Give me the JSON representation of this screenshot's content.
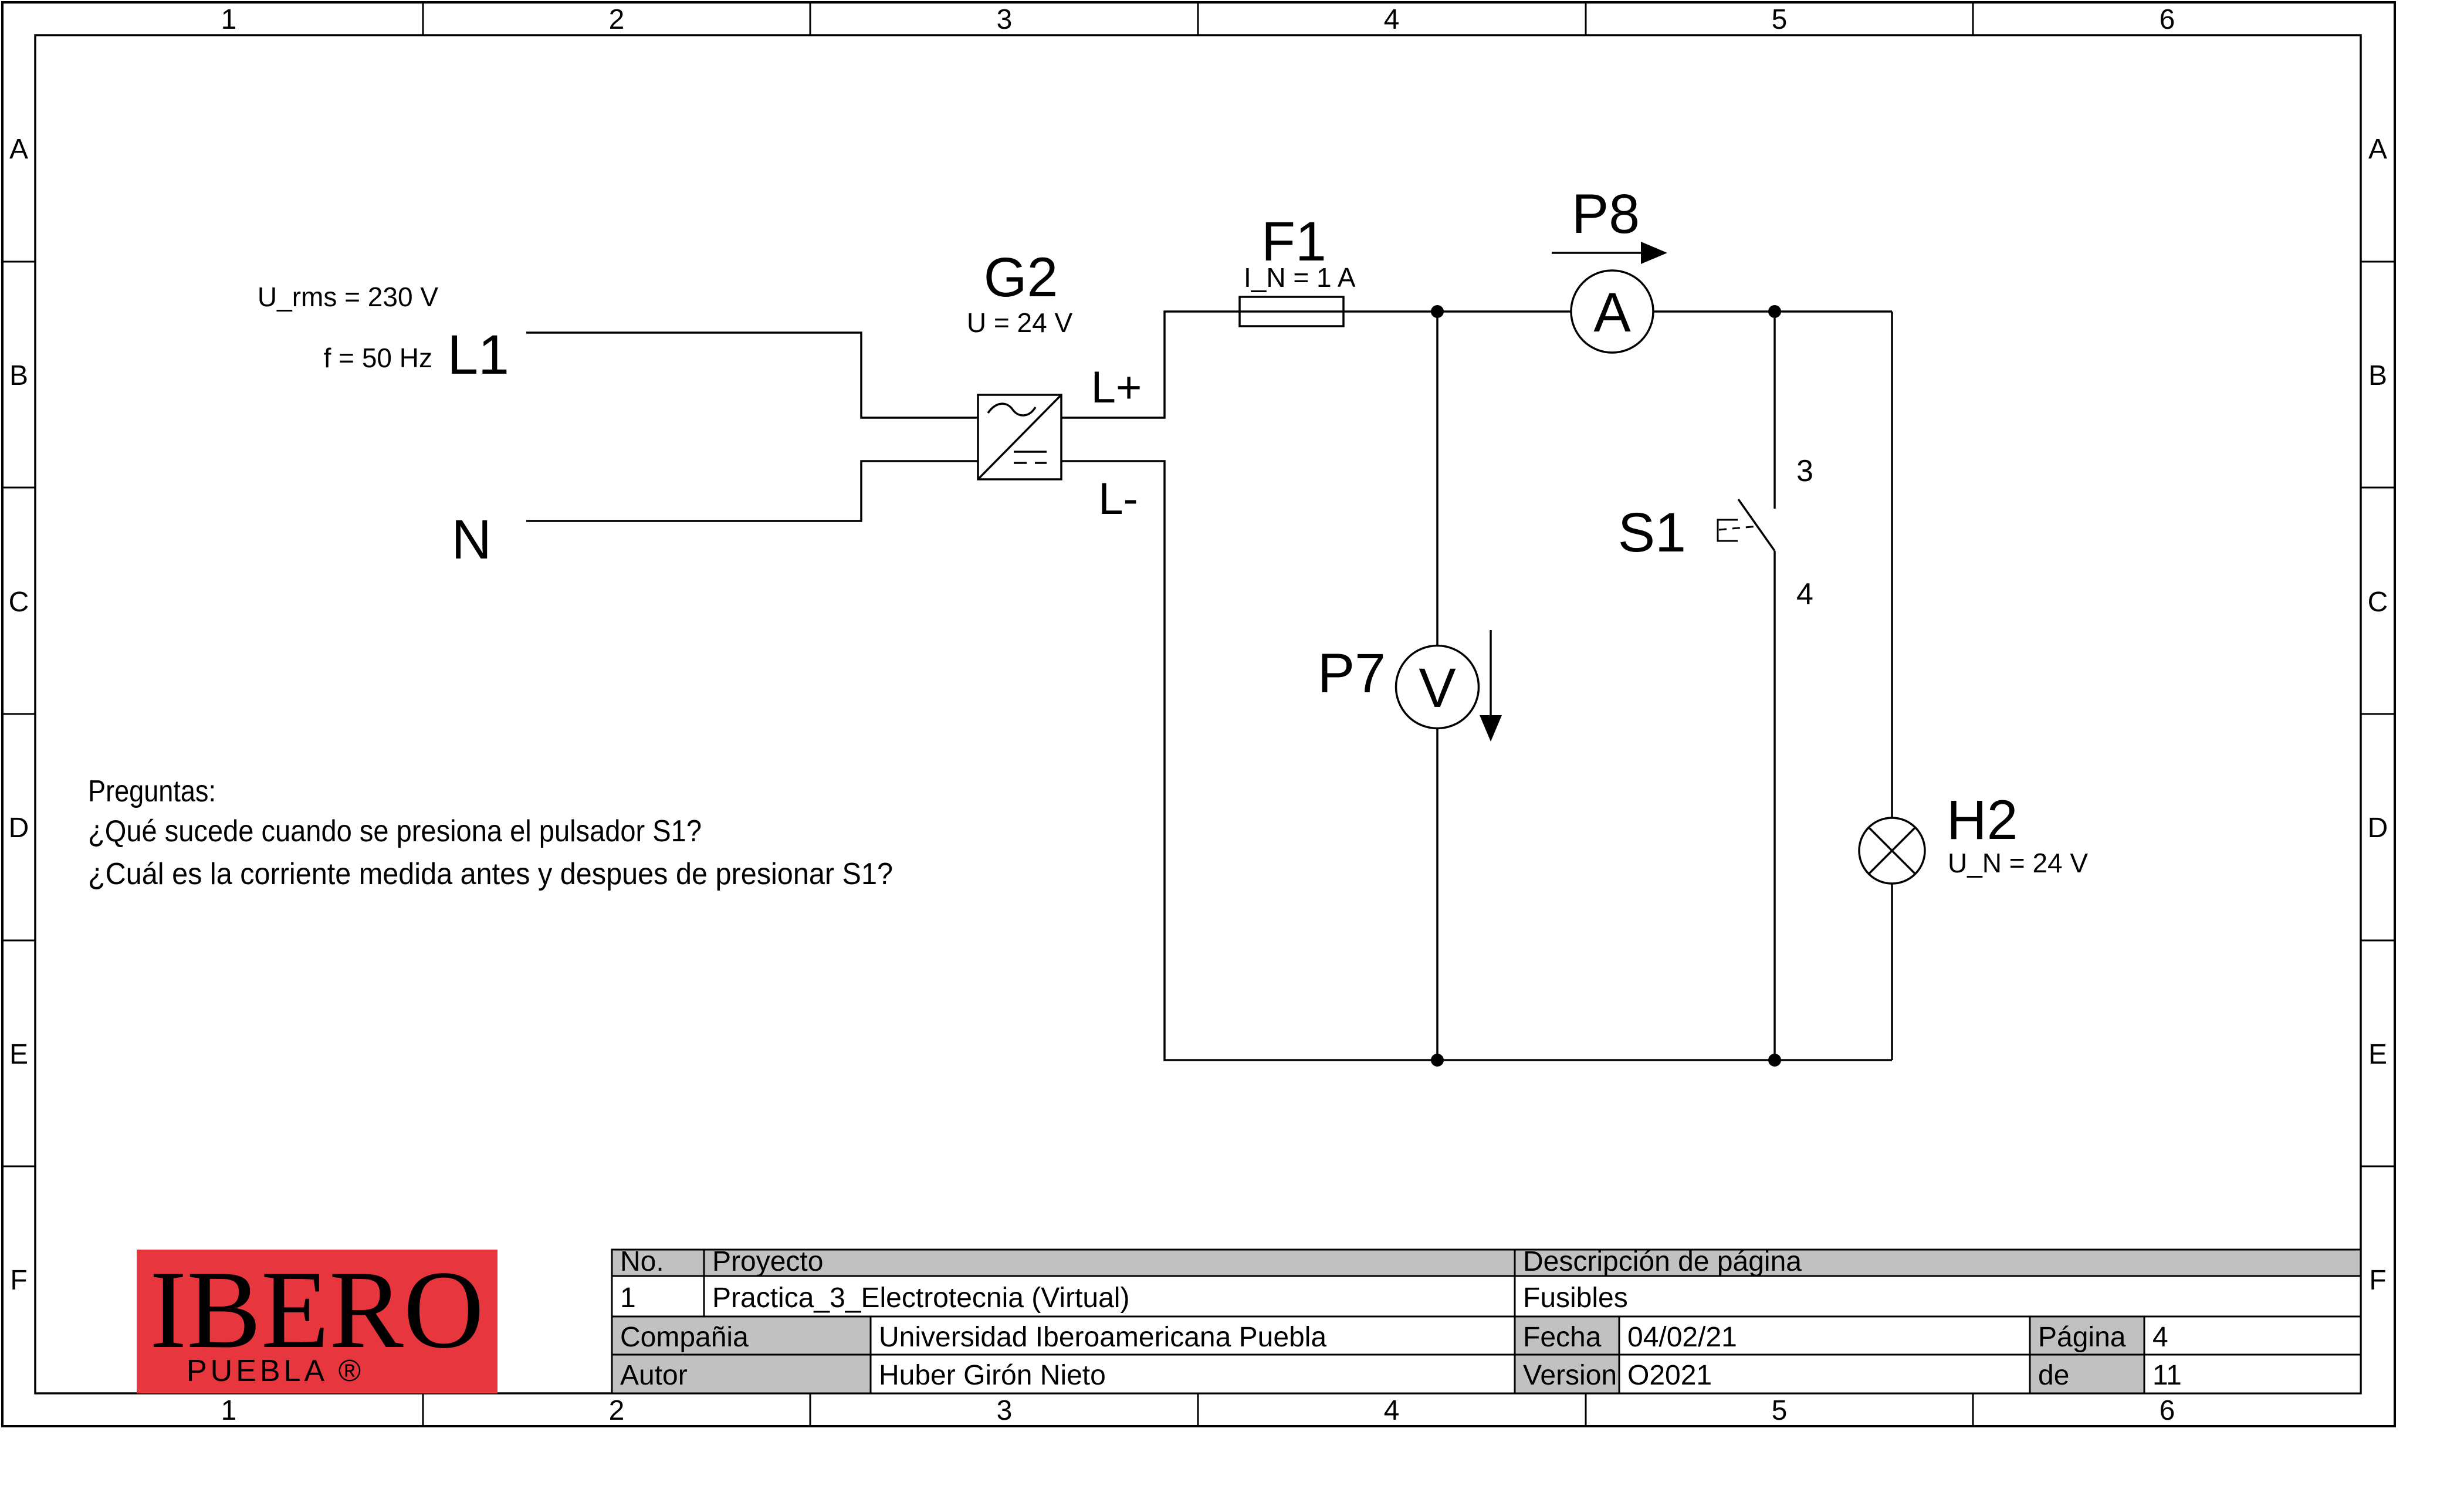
{
  "frame": {
    "cols": [
      "1",
      "2",
      "3",
      "4",
      "5",
      "6"
    ],
    "rows": [
      "A",
      "B",
      "C",
      "D",
      "E",
      "F"
    ]
  },
  "source": {
    "voltage": "U_rms = 230 V",
    "frequency": "f = 50 Hz",
    "line_label": "L1",
    "neutral_label": "N"
  },
  "psu": {
    "ref": "G2",
    "value": "U = 24 V",
    "out_pos": "L+",
    "out_neg": "L-"
  },
  "fuse": {
    "ref": "F1",
    "value": "I_N = 1 A"
  },
  "ammeter": {
    "ref": "P8",
    "letter": "A"
  },
  "voltmeter": {
    "ref": "P7",
    "letter": "V"
  },
  "switch": {
    "ref": "S1",
    "terminal_top": "3",
    "terminal_bottom": "4"
  },
  "lamp": {
    "ref": "H2",
    "value": "U_N = 24 V"
  },
  "questions": {
    "title": "Preguntas:",
    "q1": "¿Qué sucede cuando se presiona el pulsador S1?",
    "q2": "¿Cuál es la corriente medida antes y despues de presionar S1?"
  },
  "titleblock": {
    "no_label": "No.",
    "no_value": "1",
    "project_label": "Proyecto",
    "project_value": "Practica_3_Electrotecnia (Virtual)",
    "description_label": "Descripción de página",
    "description_value": "Fusibles",
    "company_label": "Compañia",
    "company_value": "Universidad Iberoamericana Puebla",
    "author_label": "Autor",
    "author_value": "Huber Girón Nieto",
    "date_label": "Fecha",
    "date_value": "04/02/21",
    "version_label": "Version",
    "version_value": "O2021",
    "page_label": "Página",
    "page_value": "4",
    "of_label": "de",
    "of_value": "11"
  },
  "logo": {
    "name": "IBERO",
    "sub": "PUEBLA ®"
  },
  "colors": {
    "header_gray": "#c1c1c1",
    "logo_red": "#e8363f",
    "line": "#000000"
  }
}
